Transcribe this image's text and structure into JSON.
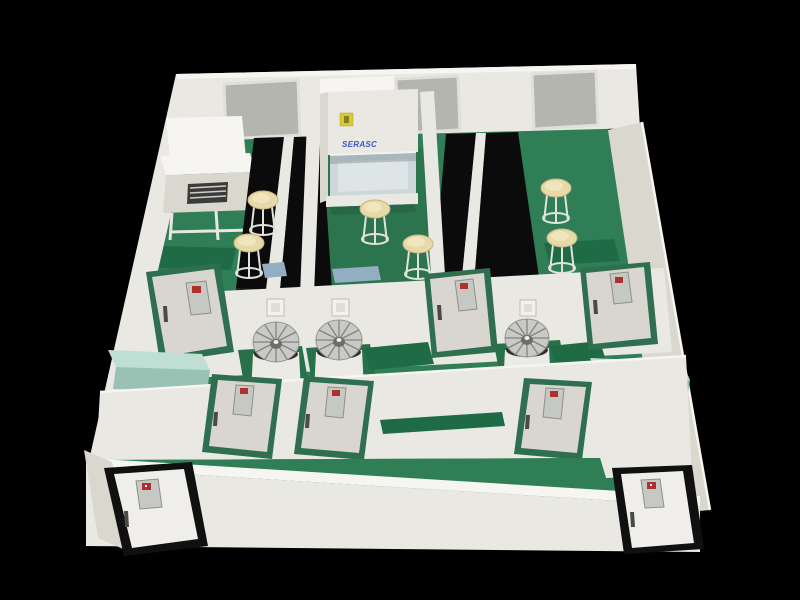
{
  "scene": {
    "description": "3D cutaway rendering of a laboratory floor plan viewed from above on a black background",
    "view": "isometric cutaway",
    "rooms": "open lab with benches at rear, equipment alcoves and small rooms in the middle band, entry corridor at front"
  },
  "cabinet": {
    "brand_label": "SERASC",
    "sticker": "yellow warning sticker"
  },
  "colors": {
    "bg": "#000000",
    "wall": "#EAE8E2",
    "wall_shade": "#DAD7CF",
    "wall_dark": "#C8C5BC",
    "wall_bright": "#F6F5F1",
    "floor_green": "#2F7E55",
    "floor_green_dark": "#27704A",
    "counter_green": "#1E6B46",
    "mint": "#BFDFD5",
    "mint_dark": "#99C2B4",
    "bench_black": "#0B0B0B",
    "window_gray": "#B5B5B0",
    "window_frame": "#E0DFDB",
    "door_gray": "#D8D6CE",
    "door_frame_green": "#2F6F50",
    "door_window": "#C6C9C3",
    "sign_red": "#B03030",
    "stool_beige": "#E7DAA8",
    "fan_silver": "#C9C9C7",
    "glass": "#CCD7D9",
    "logo_blue": "#3A57C4",
    "sticker_yellow": "#D9C935",
    "exit_frame_black": "#101010",
    "drain_blue": "#93AEC2"
  },
  "inventory": {
    "rear_wall_windows": 3,
    "black_benches": 4,
    "stools": 6,
    "fan_units": 3,
    "interior_doors": 6,
    "exit_doors": 2,
    "switch_boxes": 3,
    "side_benches": 2,
    "biosafety_cabinets": 1,
    "workstations": 1
  }
}
